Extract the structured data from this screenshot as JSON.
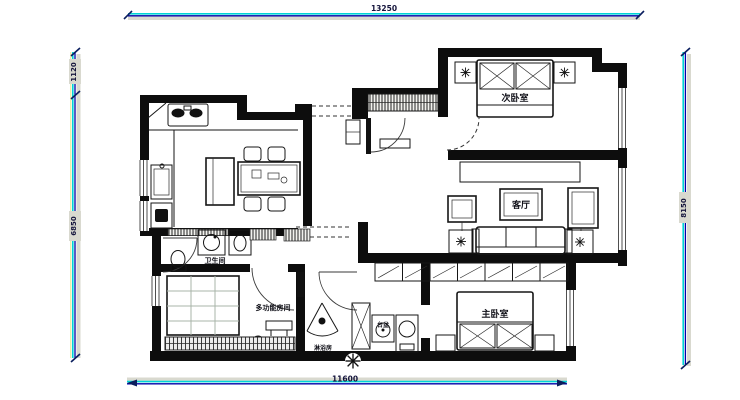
{
  "dimensions": {
    "top": "13250",
    "bottom": "11600",
    "left_upper": "1120",
    "left_lower": "6850",
    "right": "8150"
  },
  "labels": {
    "secondary_bedroom": "次卧室",
    "living_room": "客厅",
    "master_bedroom": "主卧室",
    "bathroom": "卫生间",
    "multi_room": "多功能房间",
    "shower_room": "淋浴房",
    "basin": "台盆"
  },
  "colors": {
    "wall": "#0d0d0d",
    "dim_cyan": "#00d6d6",
    "dim_navy": "#0000a8",
    "dim_band": "#d9d9cf",
    "paper": "#ffffff"
  }
}
